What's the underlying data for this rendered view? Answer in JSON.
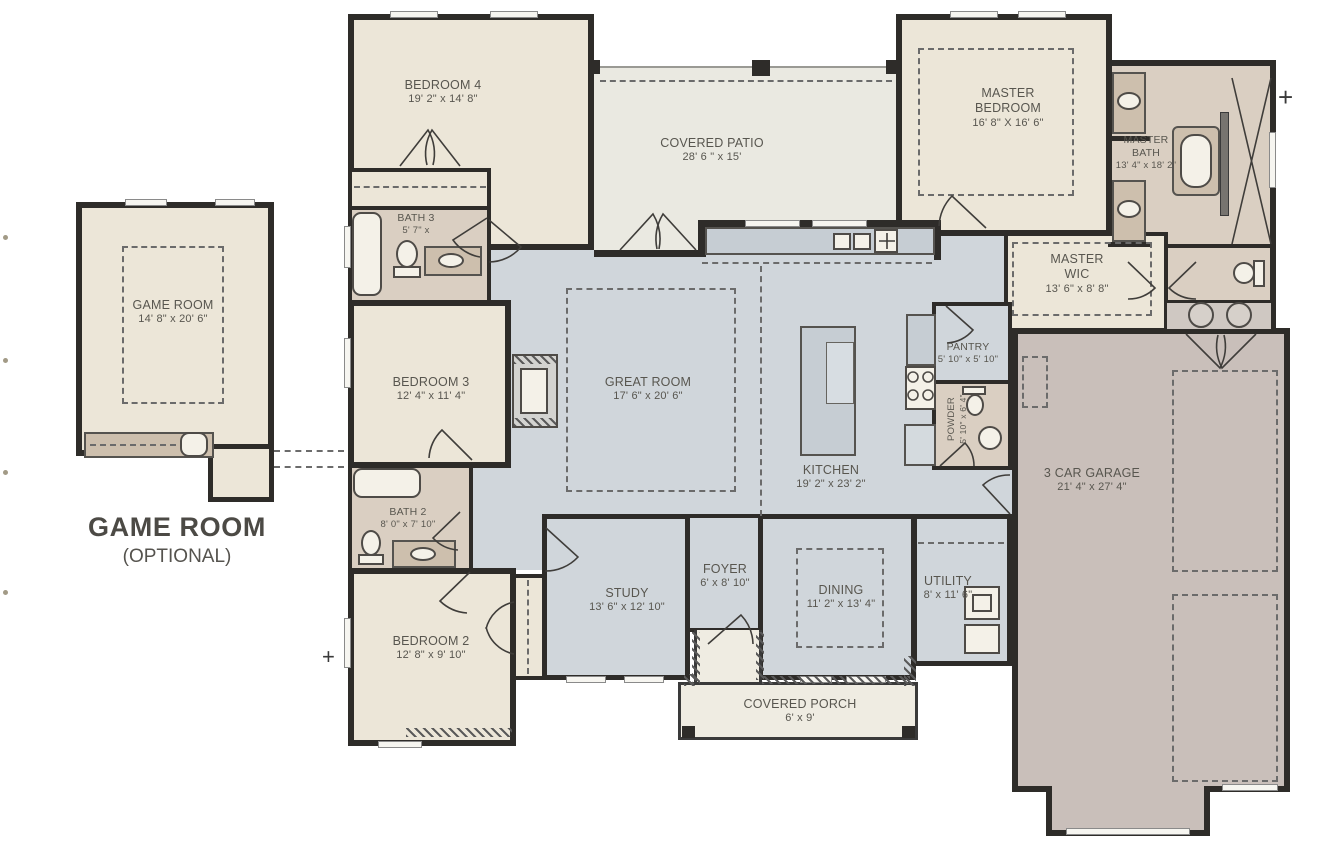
{
  "palette": {
    "wall": "#2e2c29",
    "bedroom_fill": "#ece6d8",
    "living_fill": "#d0d6db",
    "bath_fill": "#dacfc2",
    "patio_fill": "#eae9e1",
    "garage_fill": "#c9bfba",
    "porch_fill": "#efece2",
    "counter_fill": "#c6cdd3",
    "text": "#58564f"
  },
  "optional_unit": {
    "title": "GAME ROOM",
    "subtitle": "(OPTIONAL)"
  },
  "markers": {
    "plus_right": "+",
    "plus_left": "+"
  },
  "rooms": {
    "game_room": {
      "name": "GAME ROOM",
      "dims": "14' 8\" x 20' 6\""
    },
    "bedroom4": {
      "name": "BEDROOM 4",
      "dims": "19' 2\" x 14' 8\""
    },
    "covered_patio": {
      "name": "COVERED PATIO",
      "dims": "28' 6 \" x 15'"
    },
    "master_bedroom": {
      "name": "MASTER BEDROOM",
      "dims": "16' 8\" X 16' 6\""
    },
    "master_bath": {
      "name": "MASTER BATH",
      "dims": "13' 4\" x 18' 2\""
    },
    "master_wic": {
      "name": "MASTER WIC",
      "dims": "13' 6\" x 8' 8\""
    },
    "bath3": {
      "name": "BATH 3",
      "dims": "5' 7\" x"
    },
    "bedroom3": {
      "name": "BEDROOM 3",
      "dims": "12' 4\" x 11' 4\""
    },
    "great_room": {
      "name": "GREAT ROOM",
      "dims": "17' 6\" x 20' 6\""
    },
    "kitchen": {
      "name": "KITCHEN",
      "dims": "19' 2\" x 23' 2\""
    },
    "pantry": {
      "name": "PANTRY",
      "dims": "5' 10\" x 5' 10\""
    },
    "powder": {
      "name": "POWDER",
      "dims": "5' 10\" x 6' 4\""
    },
    "garage": {
      "name": "3 CAR GARAGE",
      "dims": "21' 4\" x 27' 4\""
    },
    "bath2": {
      "name": "BATH 2",
      "dims": "8' 0\" x 7' 10\""
    },
    "bedroom2": {
      "name": "BEDROOM 2",
      "dims": "12' 8\" x 9' 10\""
    },
    "study": {
      "name": "STUDY",
      "dims": "13' 6\" x 12' 10\""
    },
    "foyer": {
      "name": "FOYER",
      "dims": "6' x 8' 10\""
    },
    "dining": {
      "name": "DINING",
      "dims": "11' 2\" x 13' 4\""
    },
    "utility": {
      "name": "UTILITY",
      "dims": "8' x 11' 6\""
    },
    "covered_porch": {
      "name": "COVERED PORCH",
      "dims": "6' x 9'"
    }
  }
}
